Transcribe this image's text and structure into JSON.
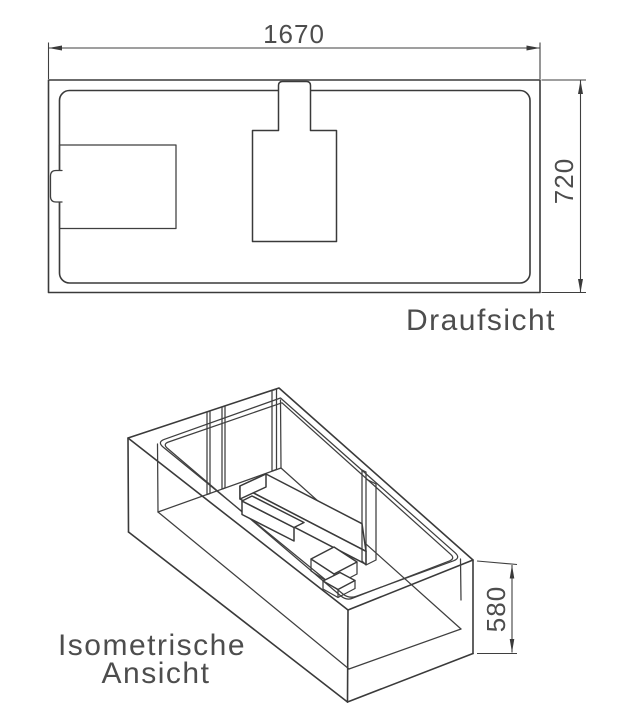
{
  "style": {
    "background": "#ffffff",
    "line_color": "#3a3a3a",
    "text_color": "#4d4d4d"
  },
  "top_view": {
    "label": "Draufsicht",
    "dim_width": "1670",
    "dim_depth": "720"
  },
  "isometric_view": {
    "label_line1": "Isometrische",
    "label_line2": "Ansicht",
    "dim_height": "580"
  }
}
